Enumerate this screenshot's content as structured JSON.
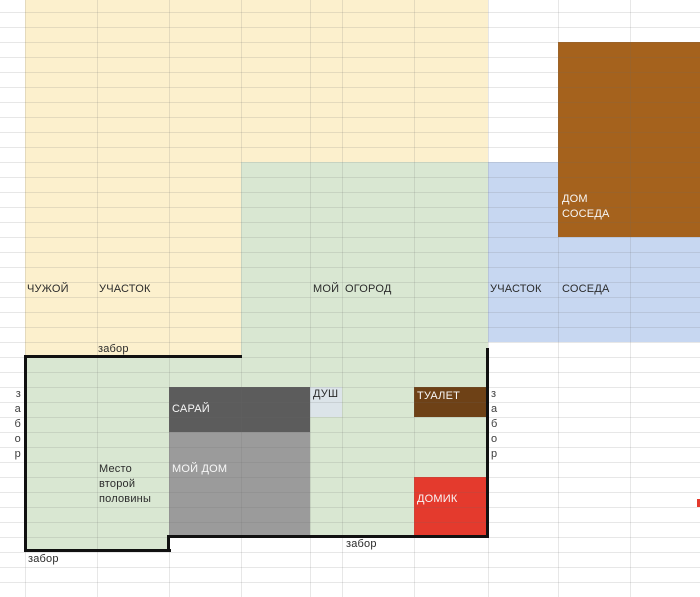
{
  "app": {
    "kind": "spreadsheet-plot-plan",
    "language": "ru"
  },
  "grid": {
    "width": 700,
    "height": 597,
    "col_boundaries": [
      25,
      97,
      169,
      241,
      310,
      342,
      414,
      488,
      558,
      630
    ],
    "row_first": 12,
    "row_step": 15,
    "row_last": 582,
    "line_color": "rgba(105,105,105,0.16)"
  },
  "colors": {
    "background": "#ffffff",
    "cream": "#fcf0cd",
    "green": "#d9e7d2",
    "blue": "#c7d7f1",
    "brown_house": "#a5621d",
    "brown_toilet": "#6e4116",
    "red": "#e43a2d",
    "dark_gray": "#5c5c5c",
    "mid_gray": "#9b9b9b",
    "shower_gray": "#dce4e9",
    "fence_black": "#111111",
    "text_dark": "#2b2b2b",
    "text_light": "#f7f7f7",
    "text_gray": "#3d3d3d"
  },
  "regions": [
    {
      "name": "region-chuzhoy-uchastok",
      "x": 25,
      "y": 0,
      "w": 463,
      "h": 357,
      "fill": "#fcf0cd"
    },
    {
      "name": "region-moy-ogorod",
      "x": 241,
      "y": 162,
      "w": 247,
      "h": 195,
      "fill": "#d9e7d2"
    },
    {
      "name": "region-my-plot-main",
      "x": 25,
      "y": 357,
      "w": 463,
      "h": 180,
      "fill": "#d9e7d2"
    },
    {
      "name": "region-my-plot-ext",
      "x": 25,
      "y": 537,
      "w": 144,
      "h": 14,
      "fill": "#d9e7d2"
    },
    {
      "name": "region-uchastok-soseda",
      "x": 488,
      "y": 162,
      "w": 212,
      "h": 180,
      "fill": "#c7d7f1"
    },
    {
      "name": "region-dom-soseda",
      "x": 558,
      "y": 42,
      "w": 142,
      "h": 195,
      "fill": "#a5621d"
    },
    {
      "name": "region-saray",
      "x": 169,
      "y": 387,
      "w": 141,
      "h": 45,
      "fill": "#5c5c5c"
    },
    {
      "name": "region-dush",
      "x": 310,
      "y": 387,
      "w": 32,
      "h": 30,
      "fill": "#dce4e9"
    },
    {
      "name": "region-moy-dom",
      "x": 169,
      "y": 432,
      "w": 141,
      "h": 105,
      "fill": "#9b9b9b"
    },
    {
      "name": "region-tualet",
      "x": 414,
      "y": 387,
      "w": 74,
      "h": 30,
      "fill": "#6e4116"
    },
    {
      "name": "region-domik",
      "x": 414,
      "y": 477,
      "w": 74,
      "h": 60,
      "fill": "#e43a2d"
    },
    {
      "name": "region-red-dot-edge",
      "x": 697,
      "y": 499,
      "w": 3,
      "h": 8,
      "fill": "#e43a2d"
    }
  ],
  "fence": {
    "color": "#111111",
    "segments": [
      {
        "name": "fence-top",
        "x": 24,
        "y": 355,
        "w": 218,
        "h": 3
      },
      {
        "name": "fence-left",
        "x": 24,
        "y": 355,
        "w": 3,
        "h": 197
      },
      {
        "name": "fence-bottom-left",
        "x": 24,
        "y": 549,
        "w": 147,
        "h": 3
      },
      {
        "name": "fence-step",
        "x": 167,
        "y": 535,
        "w": 3,
        "h": 17
      },
      {
        "name": "fence-bottom-right",
        "x": 167,
        "y": 535,
        "w": 322,
        "h": 3
      },
      {
        "name": "fence-right",
        "x": 486,
        "y": 348,
        "w": 3,
        "h": 190
      }
    ]
  },
  "labels": [
    {
      "name": "label-chuzhoy",
      "text": "ЧУЖОЙ",
      "x": 27,
      "y": 282,
      "color": "#2b2b2b"
    },
    {
      "name": "label-uchastok",
      "text": "УЧАСТОК",
      "x": 99,
      "y": 282,
      "color": "#2b2b2b"
    },
    {
      "name": "label-moy",
      "text": "МОЙ",
      "x": 313,
      "y": 282,
      "color": "#2b2b2b"
    },
    {
      "name": "label-ogorod",
      "text": "ОГОРОД",
      "x": 345,
      "y": 282,
      "color": "#2b2b2b"
    },
    {
      "name": "label-uchastok-2",
      "text": "УЧАСТОК",
      "x": 490,
      "y": 282,
      "color": "#2b2b2b"
    },
    {
      "name": "label-soseda-2",
      "text": "СОСЕДА",
      "x": 562,
      "y": 282,
      "color": "#2b2b2b"
    },
    {
      "name": "label-dom",
      "text": "ДОМ",
      "x": 562,
      "y": 192,
      "color": "#f7f7f7"
    },
    {
      "name": "label-soseda",
      "text": "СОСЕДА",
      "x": 562,
      "y": 207,
      "color": "#f7f7f7"
    },
    {
      "name": "label-zabor-top",
      "text": "забор",
      "x": 98,
      "y": 342,
      "color": "#2b2b2b"
    },
    {
      "name": "label-saray",
      "text": "САРАЙ",
      "x": 172,
      "y": 402,
      "color": "#f7f7f7"
    },
    {
      "name": "label-dush",
      "text": "ДУШ",
      "x": 313,
      "y": 387,
      "color": "#2b2b2b"
    },
    {
      "name": "label-tualet",
      "text": "ТУАЛЕТ",
      "x": 417,
      "y": 389,
      "color": "#f7f7f7"
    },
    {
      "name": "label-moy-dom",
      "text": "МОЙ ДОМ",
      "x": 172,
      "y": 462,
      "color": "#f7f7f7"
    },
    {
      "name": "label-mesto",
      "text": "Место",
      "x": 99,
      "y": 462,
      "color": "#2b2b2b"
    },
    {
      "name": "label-vtoroy",
      "text": "второй",
      "x": 99,
      "y": 477,
      "color": "#2b2b2b"
    },
    {
      "name": "label-poloviny",
      "text": "половины",
      "x": 99,
      "y": 492,
      "color": "#2b2b2b"
    },
    {
      "name": "label-domik",
      "text": "ДОМИК",
      "x": 417,
      "y": 492,
      "color": "#f7f7f7"
    },
    {
      "name": "label-zabor-bottom-right",
      "text": "забор",
      "x": 346,
      "y": 537,
      "color": "#2b2b2b"
    },
    {
      "name": "label-zabor-bottom-left",
      "text": "забор",
      "x": 28,
      "y": 552,
      "color": "#2b2b2b"
    }
  ],
  "vertical_fence_labels": [
    {
      "name": "label-zabor-vertical-left",
      "letters": [
        "з",
        "а",
        "б",
        "о",
        "р"
      ],
      "x": 8,
      "w": 13,
      "y_start": 387,
      "step": 15,
      "align": "right",
      "color": "#3d3d3d"
    },
    {
      "name": "label-zabor-vertical-right",
      "letters": [
        "з",
        "а",
        "б",
        "о",
        "р"
      ],
      "x": 491,
      "w": 13,
      "y_start": 387,
      "step": 15,
      "align": "left",
      "color": "#3d3d3d"
    }
  ]
}
